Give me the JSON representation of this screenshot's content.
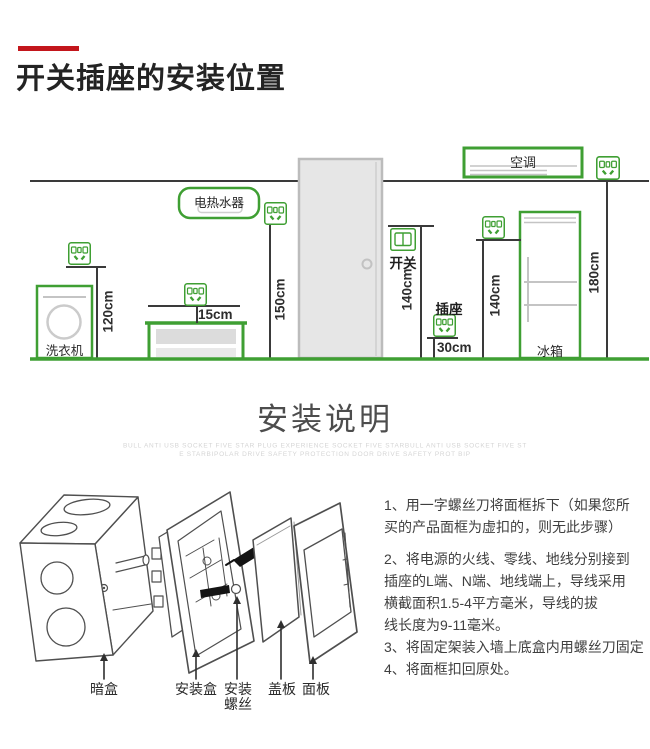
{
  "header": {
    "title": "开关插座的安装位置"
  },
  "room": {
    "appliances": {
      "washer": "洗衣机",
      "water_heater": "电热水器",
      "air_conditioner": "空调",
      "fridge": "冰箱"
    },
    "devices": {
      "switch": "开关",
      "socket": "插座"
    },
    "heights": {
      "washer_socket": "120cm",
      "counter_socket": "15cm",
      "water_heater_socket": "150cm",
      "switch": "140cm",
      "low_socket": "30cm",
      "fridge_socket": "140cm",
      "ac_socket": "180cm"
    }
  },
  "install": {
    "heading": "安装说明",
    "watermark": {
      "line1": "BULL ANTI USB SOCKET FIVE STAR PLUG EXPERIENCE SOCKET FIVE STARBULL ANTI USB SOCKET FIVE ST",
      "line2": "E STARBIPOLAR DRIVE SAFETY PROTECTION DOOR  DRIVE SAFETY PROT BIP"
    },
    "parts": {
      "junction_box": "暗盒",
      "mounting_box": "安装盒",
      "mounting_screws": "安装\n螺丝",
      "cover_plate": "盖板",
      "panel": "面板"
    },
    "steps": [
      "1、用一字螺丝刀将面框拆下（如果您所",
      "买的产品面框为虚扣的，则无此步骤）",
      "2、将电源的火线、零线、地线分别接到",
      "插座的L端、N端、地线端上，导线采用",
      "横截面积1.5-4平方毫米，导线的拔",
      "线长度为9-11毫米。",
      "3、将固定架装入墙上底盒内用螺丝刀固定",
      "4、将面框扣回原处。"
    ]
  },
  "colors": {
    "accent_red": "#c3161c",
    "outline_green": "#3f9f33"
  }
}
